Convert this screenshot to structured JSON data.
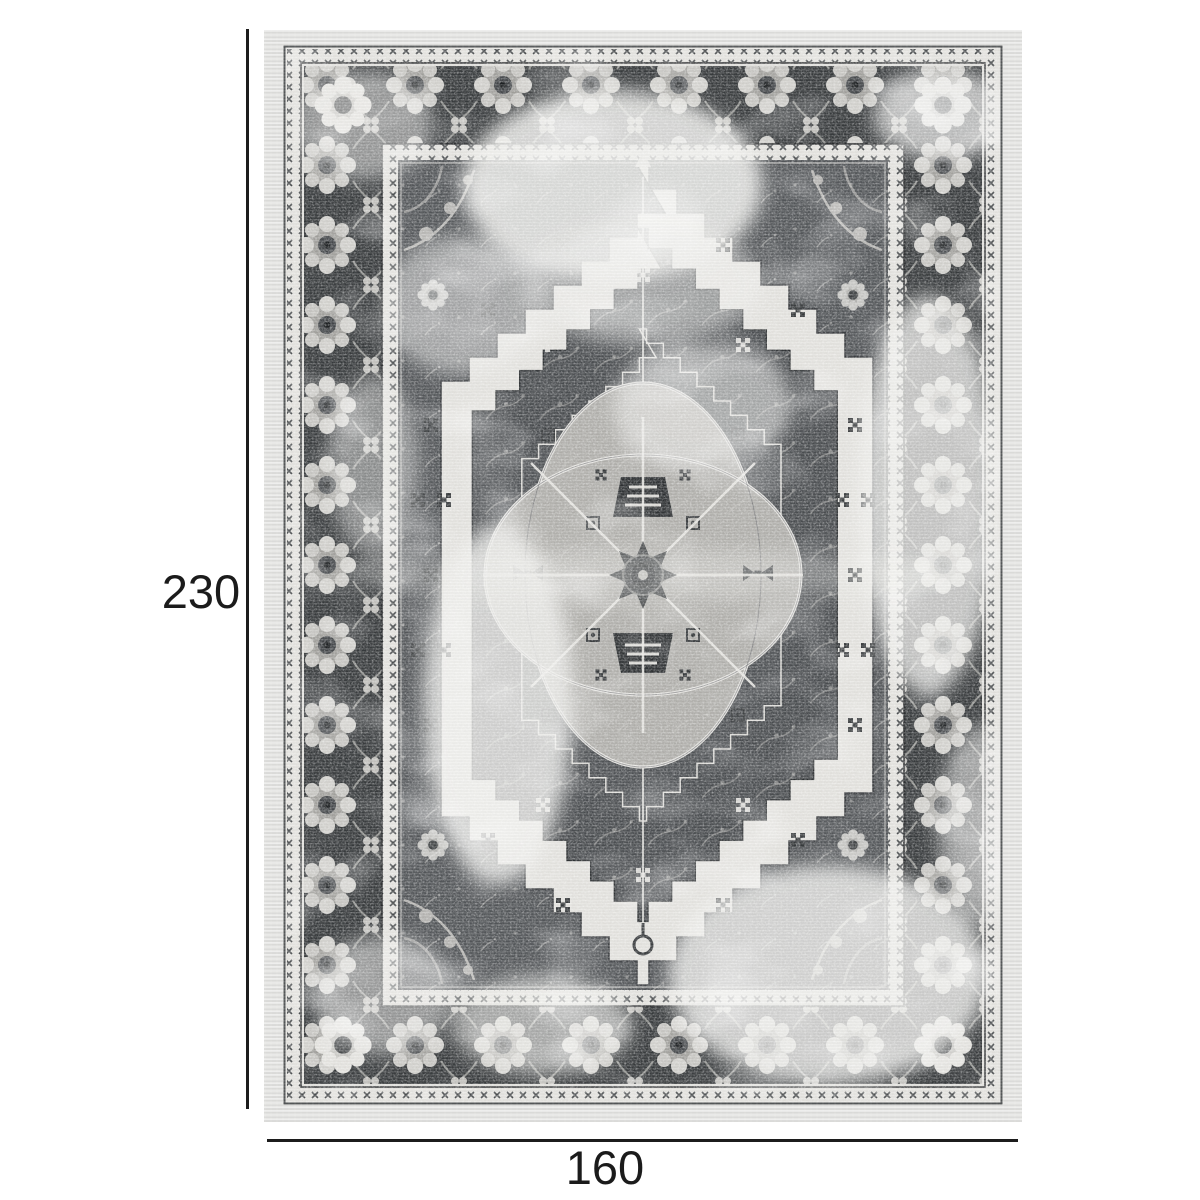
{
  "page": {
    "background_color": "#ffffff"
  },
  "product_figure": {
    "alt": "Vintage distressed grey medallion area rug"
  },
  "dimensions": {
    "height": {
      "label": "230"
    },
    "width": {
      "label": "160"
    }
  },
  "colors": {
    "dimension_line": "#1c1c1c",
    "dimension_text": "#1b1b1b",
    "rug_border_dark": "#383b3d",
    "rug_field": "#54575a",
    "rug_ivory": "#e4e3df",
    "rug_light_gray": "#c6c5c1",
    "rug_selvedge": "#e6e6e4",
    "rug_medallion": "#b1b0ac"
  }
}
